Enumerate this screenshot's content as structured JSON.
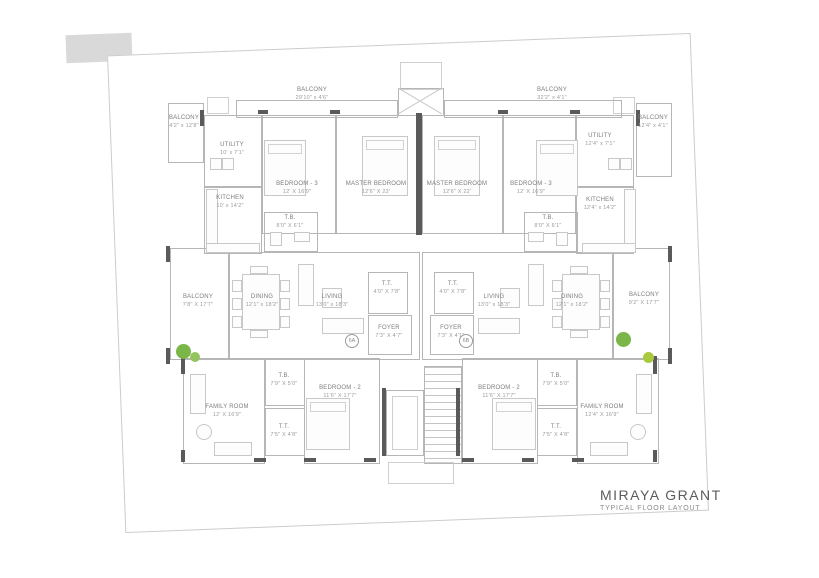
{
  "title_block": {
    "project": "MIRAYA GRANT",
    "subtitle": "TYPICAL FLOOR LAYOUT"
  },
  "units": {
    "left": "6A",
    "right": "6B"
  },
  "rooms": {
    "l_balcony_top": {
      "name": "BALCONY",
      "dims": "29'10\" x 4'6\""
    },
    "l_balcony_side": {
      "name": "BALCONY",
      "dims": "4'2\" x 12'8\""
    },
    "l_utility": {
      "name": "UTILITY",
      "dims": "10' x 7'1\""
    },
    "l_kitchen": {
      "name": "KITCHEN",
      "dims": "10' x 14'2\""
    },
    "l_bed3": {
      "name": "BEDROOM - 3",
      "dims": "12' X 16'9\""
    },
    "l_master": {
      "name": "MASTER BEDROOM",
      "dims": "12'6\" X 22'"
    },
    "l_tb1": {
      "name": "T.B.",
      "dims": "8'0\" X 6'1\""
    },
    "l_balcony_mid": {
      "name": "BALCONY",
      "dims": "7'8\" X 17'7\""
    },
    "l_dining": {
      "name": "DINING",
      "dims": "12'1\" x 18'2\""
    },
    "l_living": {
      "name": "LIVING",
      "dims": "13'0\" x 18'3\""
    },
    "l_tt": {
      "name": "T.T.",
      "dims": "4'0\" X 7'8\""
    },
    "l_foyer": {
      "name": "FOYER",
      "dims": "7'3\" X 4'7\""
    },
    "l_family": {
      "name": "FAMILY ROOM",
      "dims": "12' X 16'9\""
    },
    "l_bed2": {
      "name": "BEDROOM - 2",
      "dims": "11'6\" X 17'7\""
    },
    "l_tb2": {
      "name": "T.B.",
      "dims": "7'9\" X 5'0\""
    },
    "l_tt2": {
      "name": "T.T.",
      "dims": "7'5\" X 4'8\""
    },
    "r_balcony_top": {
      "name": "BALCONY",
      "dims": "32'2\" x 4'1\""
    },
    "r_balcony_side": {
      "name": "BALCONY",
      "dims": "12'4\" x 4'1\""
    },
    "r_utility": {
      "name": "UTILITY",
      "dims": "12'4\" x 7'1\""
    },
    "r_kitchen": {
      "name": "KITCHEN",
      "dims": "12'4\" x 14'2\""
    },
    "r_bed3": {
      "name": "BEDROOM - 3",
      "dims": "12' X 16'9\""
    },
    "r_master": {
      "name": "MASTER BEDROOM",
      "dims": "12'6\" X 22'"
    },
    "r_tb1": {
      "name": "T.B.",
      "dims": "8'0\" X 6'1\""
    },
    "r_balcony_mid": {
      "name": "BALCONY",
      "dims": "9'2\" X 17'7\""
    },
    "r_dining": {
      "name": "DINING",
      "dims": "12'1\" x 18'2\""
    },
    "r_living": {
      "name": "LIVING",
      "dims": "13'0\" x 18'3\""
    },
    "r_tt": {
      "name": "T.T.",
      "dims": "4'0\" X 7'8\""
    },
    "r_foyer": {
      "name": "FOYER",
      "dims": "7'3\" X 4'1\""
    },
    "r_family": {
      "name": "FAMILY ROOM",
      "dims": "12'4\" X 16'9\""
    },
    "r_bed2": {
      "name": "BEDROOM - 2",
      "dims": "11'6\" X 17'7\""
    },
    "r_tb2": {
      "name": "T.B.",
      "dims": "7'9\" X 5'0\""
    },
    "r_tt2": {
      "name": "T.T.",
      "dims": "7'5\" X 4'8\""
    }
  },
  "colors": {
    "wall": "#5a5a5a",
    "line": "#b6b6b6",
    "text": "#8a8a8a",
    "plant_green": "#7ab648"
  }
}
